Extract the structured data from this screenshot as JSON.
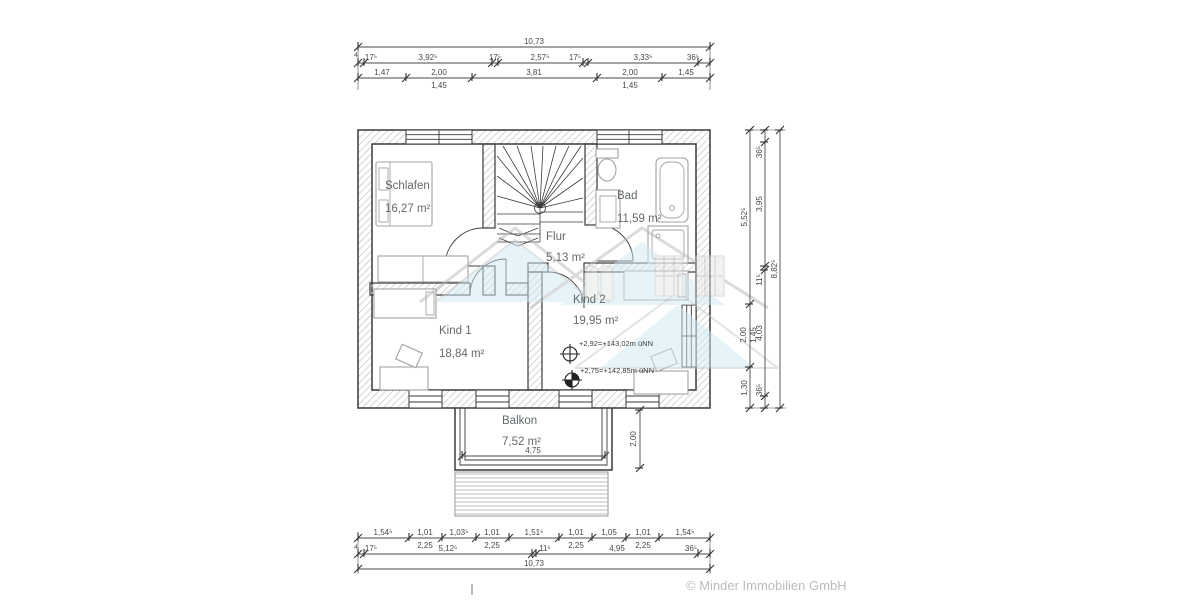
{
  "meta": {
    "copyright": "© Minder Immobilien GmbH"
  },
  "rooms": {
    "schlafen": {
      "name": "Schlafen",
      "area": "16,27 m²"
    },
    "bad": {
      "name": "Bad",
      "area": "11,59 m²"
    },
    "flur": {
      "name": "Flur",
      "area": "5,13 m²"
    },
    "kind1": {
      "name": "Kind 1",
      "area": "18,84 m²"
    },
    "kind2": {
      "name": "Kind 2",
      "area": "19,95 m²"
    },
    "balkon": {
      "name": "Balkon",
      "area": "7,52 m²"
    }
  },
  "elevations": {
    "upper": "+2,92=+143,02m üNN",
    "lower": "+2,75=+142,85m üNN"
  },
  "dims": {
    "top": {
      "total": "10,73",
      "small": "4",
      "chain": [
        "17⁵",
        "3,92⁵",
        "17⁵",
        "2,57⁵",
        "17⁵",
        "3,33⁵",
        "36⁵"
      ],
      "openings": [
        {
          "w": "1,47"
        },
        {
          "w": "2,00",
          "sill": "1,45"
        },
        {
          "w": "3,81"
        },
        {
          "w": "2,00",
          "sill": "1,45"
        },
        {
          "w": "1,45"
        }
      ]
    },
    "bottom": {
      "total": "10,73",
      "small": "4",
      "openings": [
        {
          "w": "1,54⁵"
        },
        {
          "w": "1,01",
          "sill": "2,25"
        },
        {
          "w": "1,03⁵"
        },
        {
          "w": "1,01",
          "sill": "2,25"
        },
        {
          "w": "1,51⁵"
        },
        {
          "w": "1,01",
          "sill": "2,25"
        },
        {
          "w": "1,05"
        },
        {
          "w": "1,01",
          "sill": "2,25"
        },
        {
          "w": "1,54⁵"
        }
      ],
      "chain": [
        "17⁵",
        "5,12⁵",
        "11⁵",
        "4,95",
        "36⁵"
      ]
    },
    "right": {
      "total": "8,82⁵",
      "chain": [
        "36⁵",
        "3,95",
        "11⁵",
        "4,03",
        "36⁵"
      ],
      "openings": [
        {
          "h": "5,52⁵"
        },
        {
          "h": "2,00",
          "sill": "1,45"
        },
        {
          "h": "1,30"
        }
      ]
    },
    "balcony": {
      "width": "4,75",
      "depth": "2,00"
    }
  },
  "colors": {
    "wall_line": "#3a3a3a",
    "hatch": "#cccccc",
    "furniture": "#a3a3a3",
    "label_text": "#63696d",
    "dim_text": "#474747",
    "watermark_blue": "#cfe9f5",
    "watermark_gray": "#b4b8ba",
    "copyright_text": "#bcbcbc"
  }
}
